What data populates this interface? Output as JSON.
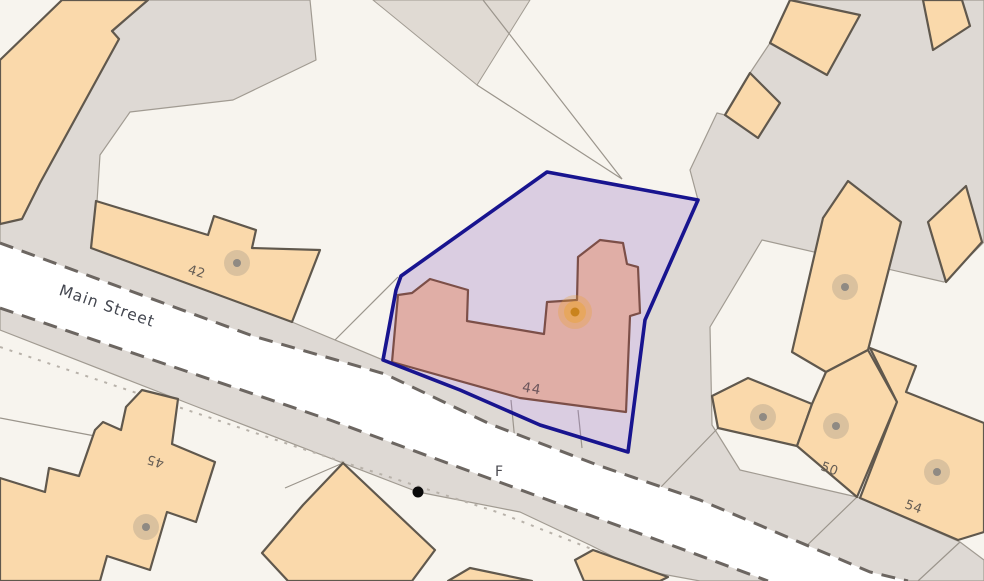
{
  "map": {
    "kind": "property-boundary-map",
    "street": {
      "name": "Main Street"
    },
    "partial_road_label": "F",
    "selected_property": {
      "plot_number": "44",
      "boundary_color": "#18148f",
      "boundary_fill": "#b79fd6",
      "building_fill": "#e1aba1",
      "marker": "orange-property-marker",
      "marker_color": "#e8a232"
    },
    "plots": {
      "p42": {
        "label": "42",
        "marker": "gray-dot"
      },
      "p44": {
        "label": "44",
        "marker": "orange-dot",
        "selected": true
      },
      "p45": {
        "label": "45",
        "marker": "gray-dot"
      },
      "p50": {
        "label": "50",
        "marker": "gray-dot"
      },
      "p54": {
        "label": "54",
        "marker": "gray-dot"
      }
    },
    "markers": {
      "gray_building_dots": 6,
      "black_node_dot": 1,
      "orange_selected_dot": 1
    },
    "colors": {
      "background": "#f7f4ee",
      "paved_area": "#ded9d4",
      "road": "#ffffff",
      "road_dash": "#6c6661",
      "building": "#fad9ab",
      "building_outline": "#60584d",
      "selection_outline": "#18148f",
      "selected_building": "#e1aba1",
      "orange_marker": "#e8a232"
    }
  },
  "labels": {
    "street": "Main Street",
    "plot42": "42",
    "plot44": "44",
    "plot45": "45",
    "plot50": "50",
    "plot54": "54",
    "partial": "F"
  }
}
